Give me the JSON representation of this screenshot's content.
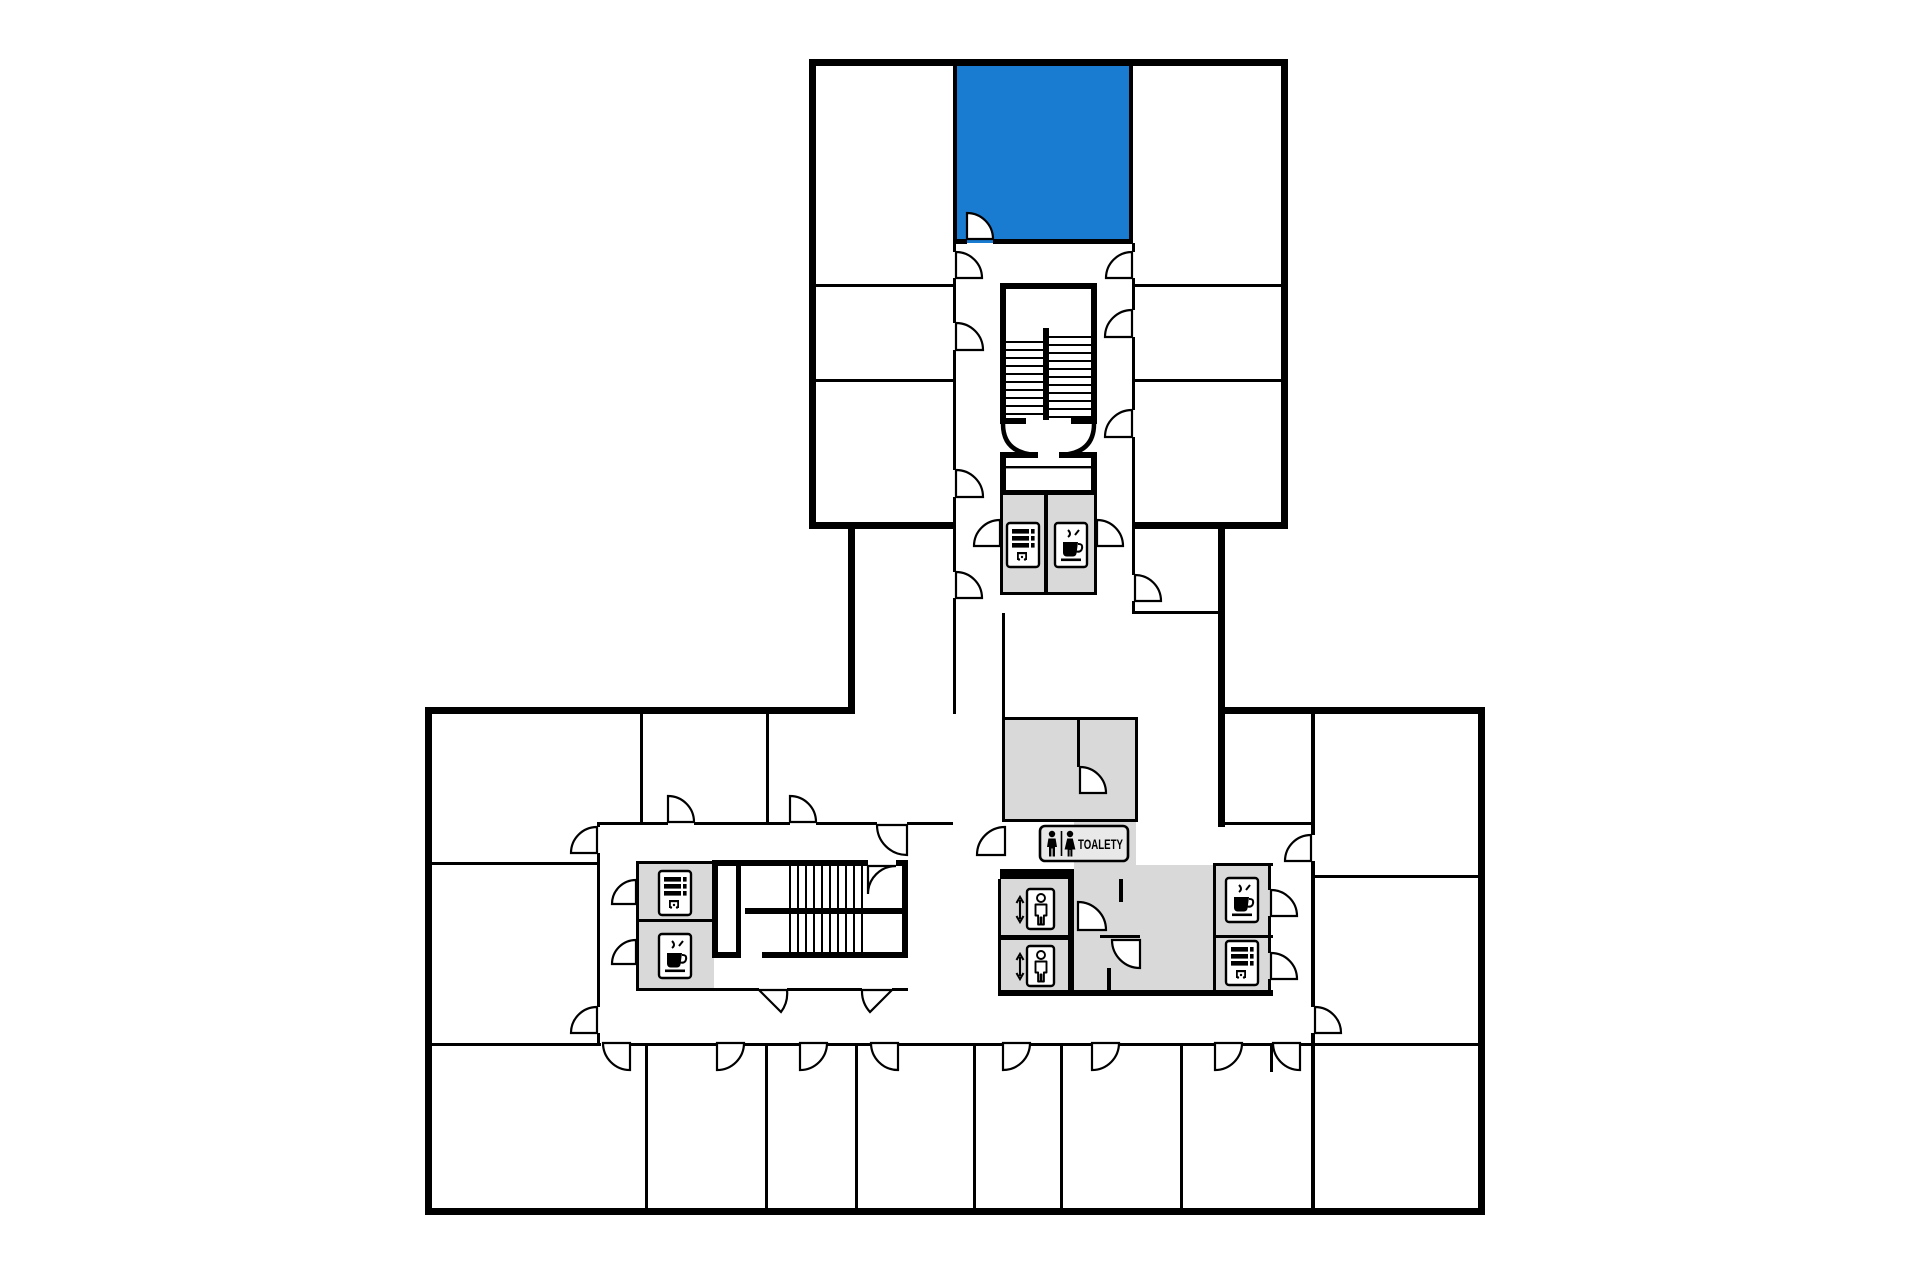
{
  "plan": {
    "toilets_sign_label": "TOALETY",
    "colors": {
      "highlight_room": "#1a7cd1",
      "service_room": "#d9d9d9",
      "wall": "#000000",
      "sign_plate": "#e9e9e9",
      "icon_plate": "#ffffff",
      "floor": "#ffffff"
    },
    "icons": [
      "vending-machine-icon",
      "coffee-icon",
      "elevator-icon",
      "man-pictogram-icon",
      "woman-pictogram-icon"
    ]
  }
}
